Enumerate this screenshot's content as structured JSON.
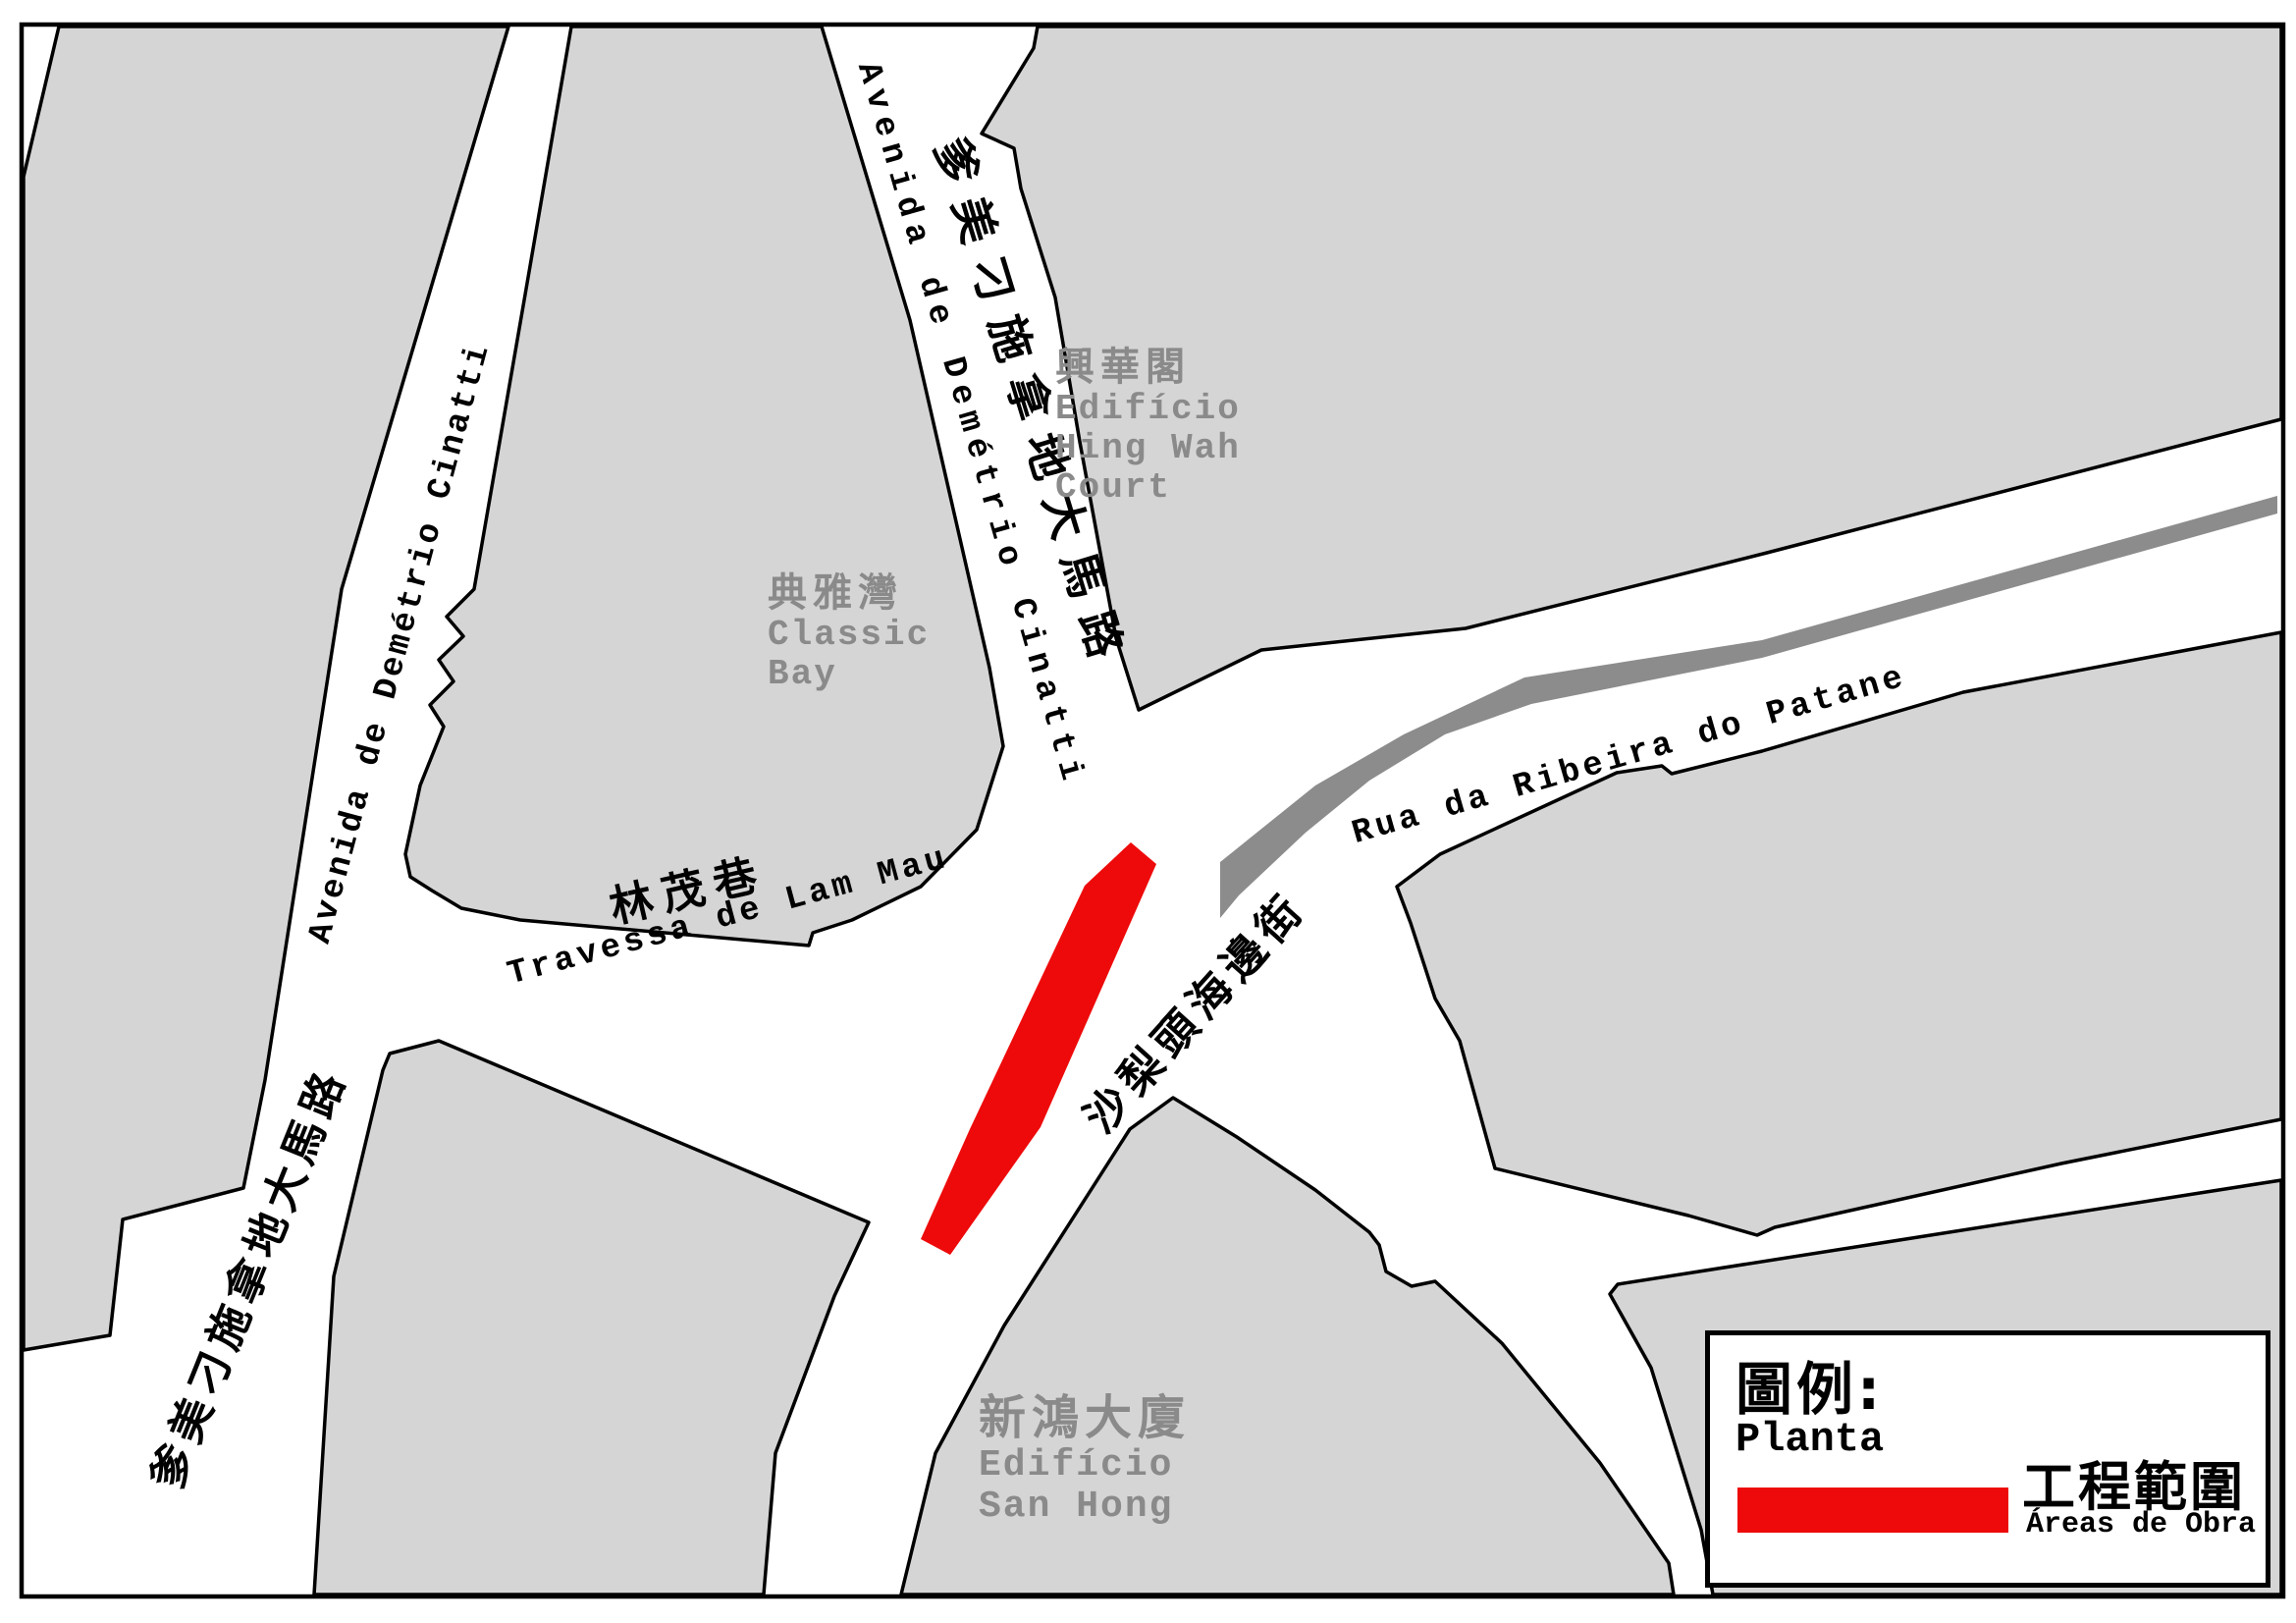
{
  "map": {
    "streets": {
      "west_avenida_pt": "Avenida de Demétrio Cinatti",
      "west_avenida_zh": "爹美刁施拿地大馬路",
      "north_avenida_pt": "Avenida de Demétrio Cinatti",
      "north_avenida_zh": "爹美刁施拿地大馬路",
      "travessa_zh": "林茂巷",
      "travessa_pt": "Travessa de Lam Mau",
      "patane_pt": "Rua da Ribeira do Patane",
      "shalitou_zh": "沙梨頭海邊街"
    },
    "buildings": {
      "hing_wah": {
        "zh": "興華閣",
        "pt_line1": "Edifício",
        "pt_line2": "Hing Wah",
        "pt_line3": "Court"
      },
      "classic_bay": {
        "zh": "典雅灣",
        "pt_line1": "Classic",
        "pt_line2": "Bay"
      },
      "san_hong": {
        "zh": "新鴻大廈",
        "pt_line1": "Edifício",
        "pt_line2": "San Hong"
      }
    },
    "legend": {
      "title_zh": "圖例:",
      "title_pt": "Planta",
      "item_zh": "工程範圍",
      "item_pt": "Áreas de Obra"
    },
    "colors": {
      "block_fill": "#d5d5d5",
      "road_fill": "#ffffff",
      "outline": "#000000",
      "creek_band": "#8c8c8c",
      "work_area_red": "#ee0a0a",
      "building_label_gray": "#8a8a8a"
    }
  }
}
